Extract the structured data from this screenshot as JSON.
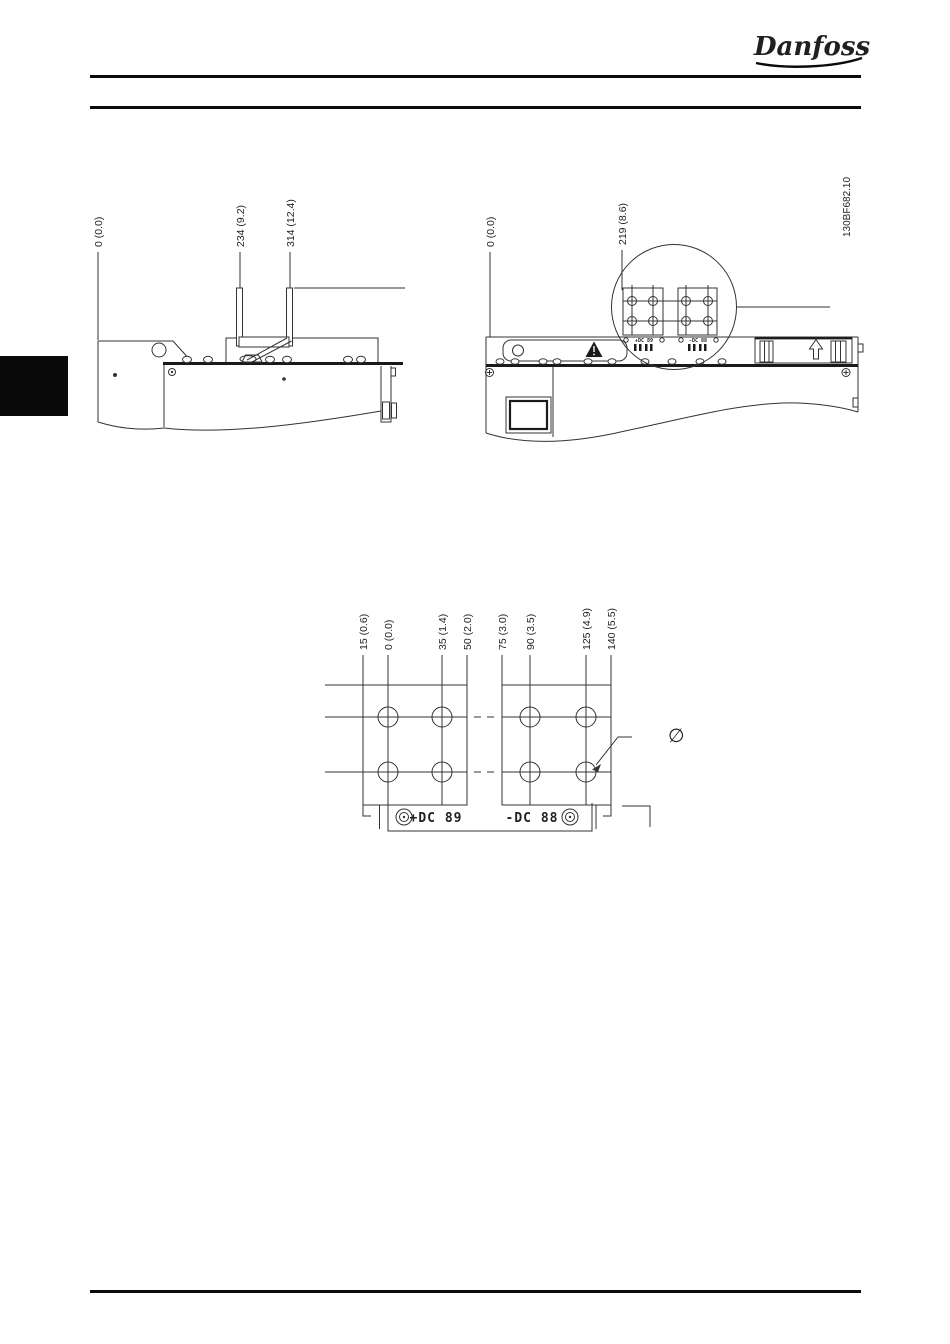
{
  "page": {
    "logo": "Danfoss",
    "artwork_id": "130BF682.10"
  },
  "figures": {
    "side_view": {
      "dims": [
        "0 (0.0)",
        "234 (9.2)",
        "314 (12.4)"
      ]
    },
    "top_view": {
      "dims": [
        "0 (0.0)",
        "219 (8.6)"
      ],
      "terminal_markings": [
        "+DC 89",
        "-DC 88"
      ]
    },
    "terminal_dims": {
      "dims": [
        "15 (0.6)",
        "0 (0.0)",
        "35 (1.4)",
        "50 (2.0)",
        "75 (3.0)",
        "90 (3.5)",
        "125 (4.9)",
        "140 (5.5)"
      ],
      "terminal_labels": [
        "+DC 89",
        "-DC 88"
      ],
      "diameter_symbol": "∅"
    }
  }
}
